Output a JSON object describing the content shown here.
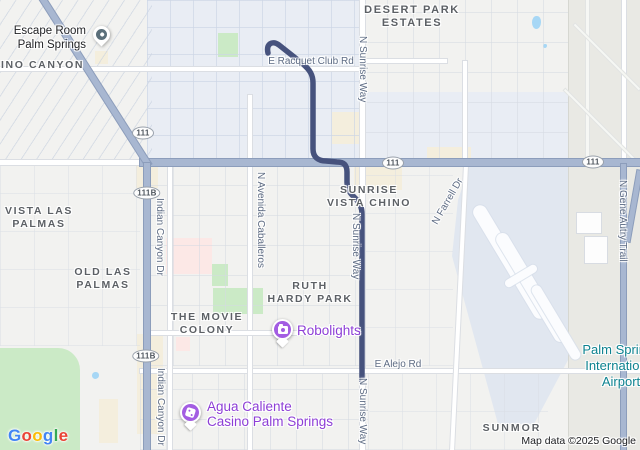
{
  "colors": {
    "route_navy": "#46527d",
    "highway_blue": "#a8b7d1",
    "marker_purple": "#a35de2",
    "poi_text_purple": "#8d3ed6",
    "airport_teal": "#0e8390",
    "park_green": "#cbeac6",
    "water_blue": "#a7d7f5",
    "neighborhood_gray": "#5c6065",
    "road_label_gray": "#5e6c84"
  },
  "neighborhoods": {
    "chino_canyon": {
      "line1": "INO CANYON"
    },
    "desert_park": {
      "line1": "DESERT PARK",
      "line2": "ESTATES"
    },
    "vista_las_palmas": {
      "line1": "VISTA LAS",
      "line2": "PALMAS"
    },
    "old_las_palmas": {
      "line1": "OLD LAS",
      "line2": "PALMAS"
    },
    "sunrise_vista_chino": {
      "line1": "SUNRISE",
      "line2": "VISTA CHINO"
    },
    "movie_colony": {
      "line1": "THE MOVIE",
      "line2": "COLONY"
    },
    "ruth_hardy_park": {
      "line1": "RUTH",
      "line2": "HARDY PARK"
    },
    "sunmor": {
      "line1": "SUNMOR"
    }
  },
  "roads": {
    "racquet_club": "E Racquet Club Rd",
    "sunrise_way_top": "N Sunrise Way",
    "sunrise_way_mid": "N Sunrise Way",
    "sunrise_way_bottom": "N Sunrise Way",
    "indian_canyon_mid": "Indian Canyon Dr",
    "indian_canyon_bottom": "Indian Canyon Dr",
    "avenida_caballeros": "N Avenida Caballeros",
    "farrell": "N Farrell Dr",
    "gene_autry": "N Gene Autry Trail",
    "alejo": "E Alejo Rd"
  },
  "shields": {
    "s1": "111",
    "s2": "111B",
    "s3": "111",
    "s4": "111",
    "s5": "111B"
  },
  "pois": {
    "escape_room": {
      "line1": "Escape Room",
      "line2": "Palm Springs"
    },
    "robolights": {
      "name": "Robolights"
    },
    "casino": {
      "line1": "Agua Caliente",
      "line2": "Casino Palm Springs"
    }
  },
  "airport": {
    "line1": "Palm Springs",
    "line2": "International",
    "line3": "Airport"
  },
  "attribution": "Map data ©2025 Google",
  "google_logo": {
    "letters": [
      "G",
      "o",
      "o",
      "g",
      "l",
      "e"
    ]
  }
}
